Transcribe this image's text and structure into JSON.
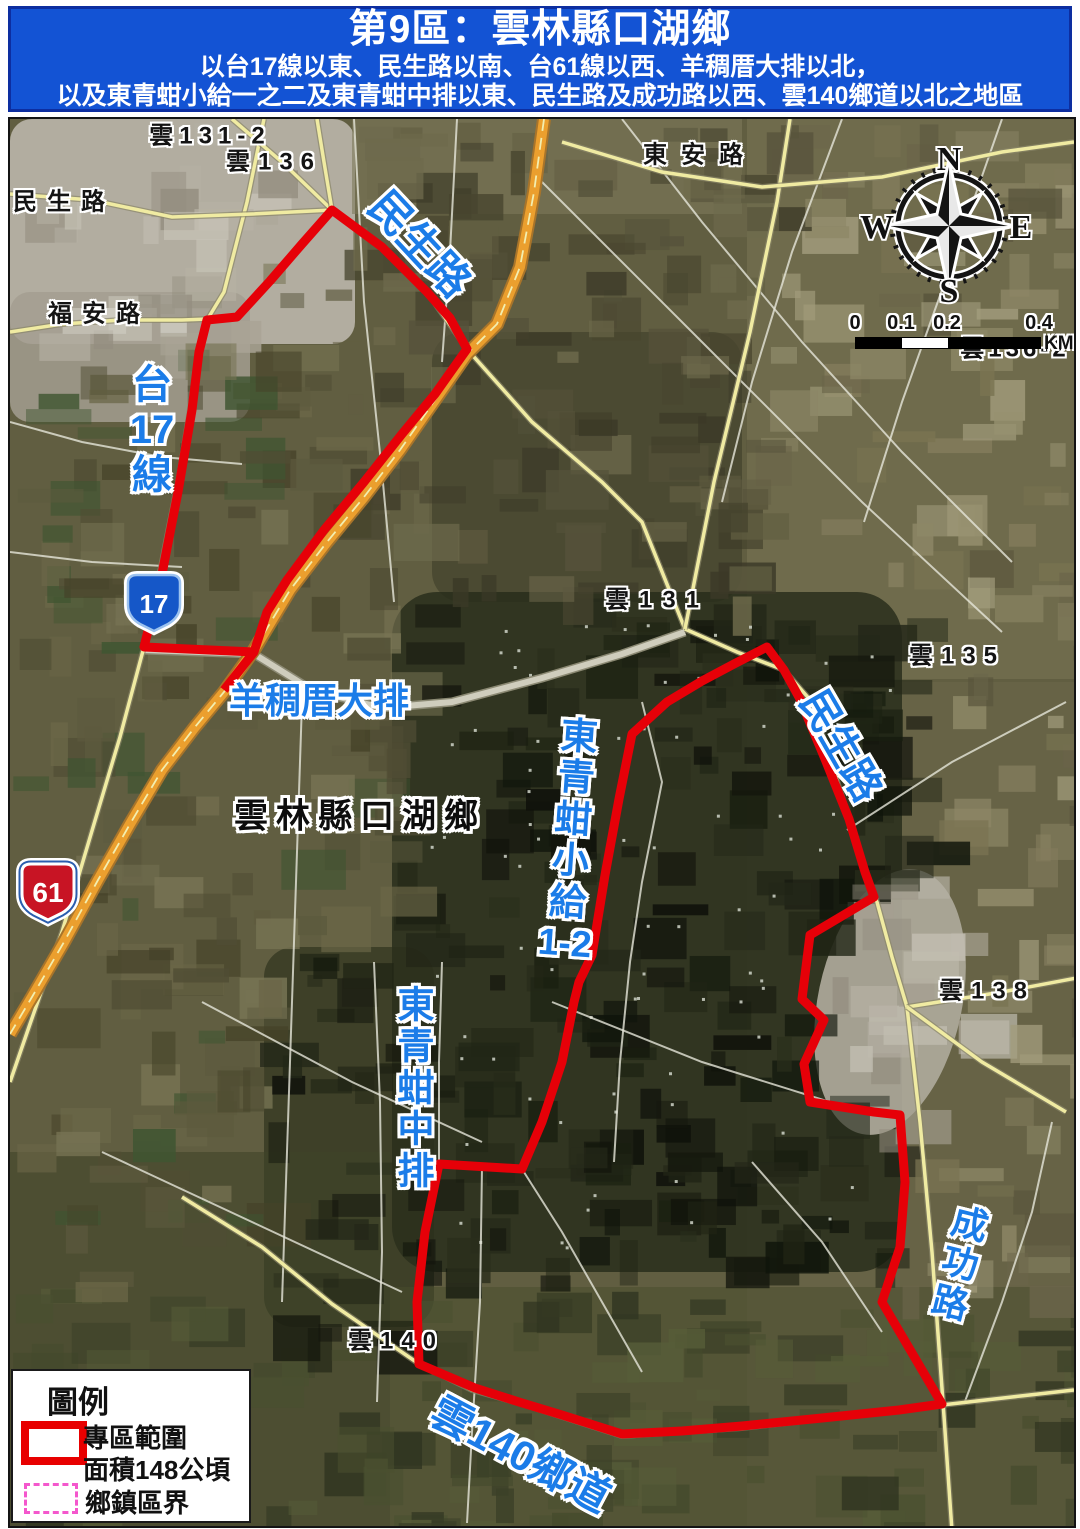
{
  "header": {
    "title": "第9區：雲林縣口湖鄉",
    "subtitle1": "以台17線以東、民生路以南、台61線以西、羊稠厝大排以北，",
    "subtitle2": "以及東青蚶小給一之二及東青蚶中排以東、民生路及成功路以西、雲140鄉道以北之地區"
  },
  "map": {
    "boundary_color": "#e60008",
    "road_label_color": "#1b7ce8",
    "labels": [
      {
        "id": "yun-131-2",
        "text": "雲131-2",
        "x": 208,
        "y": 131,
        "kind": "place",
        "ls": 6
      },
      {
        "id": "yun-136",
        "text": "雲136",
        "x": 272,
        "y": 157,
        "kind": "place",
        "ls": 8
      },
      {
        "id": "minsheng-road-black",
        "text": "民生路",
        "x": 62,
        "y": 197,
        "kind": "place",
        "ls": 10
      },
      {
        "id": "fuan-road",
        "text": "福安路",
        "x": 97,
        "y": 309,
        "kind": "place",
        "ls": 10
      },
      {
        "id": "dongan-road",
        "text": "東安路",
        "x": 698,
        "y": 150,
        "kind": "place",
        "ls": 14
      },
      {
        "id": "yun-131",
        "text": "雲131",
        "x": 655,
        "y": 595,
        "kind": "place",
        "ls": 10
      },
      {
        "id": "yun-135",
        "text": "雲135",
        "x": 955,
        "y": 651,
        "kind": "place",
        "ls": 8
      },
      {
        "id": "yun-138",
        "text": "雲138",
        "x": 985,
        "y": 986,
        "kind": "place",
        "ls": 8
      },
      {
        "id": "yun-140",
        "text": "雲140",
        "x": 394,
        "y": 1336,
        "kind": "place",
        "ls": 8
      },
      {
        "id": "yun-136-2",
        "text": "雲136-2",
        "x": 1013,
        "y": 344,
        "kind": "place",
        "ls": 4,
        "z": 20
      },
      {
        "id": "township-name",
        "text": "雲林縣口湖鄉",
        "x": 358,
        "y": 811,
        "kind": "place-big",
        "ls": 8
      },
      {
        "id": "minsheng-road-north",
        "text": "民生路",
        "x": 420,
        "y": 240,
        "kind": "road",
        "rot": 47,
        "size": 42
      },
      {
        "id": "tai-17-line",
        "parts": [
          "台",
          "17",
          "線"
        ],
        "x": 150,
        "y": 428,
        "kind": "road-v",
        "size": 40
      },
      {
        "id": "yangchoucuo-drain",
        "text": "羊稠厝大排",
        "x": 317,
        "y": 696,
        "kind": "road",
        "rot": 0,
        "size": 36
      },
      {
        "id": "dongqinghan-xiaogei-1-2",
        "parts": [
          "東",
          "青",
          "蚶",
          "小",
          "給",
          "1-2"
        ],
        "x": 570,
        "y": 838,
        "kind": "road-v",
        "size": 37,
        "rot": 4
      },
      {
        "id": "dongqinghan-zhongpai",
        "parts": [
          "東",
          "青",
          "蚶",
          "中",
          "排"
        ],
        "x": 414,
        "y": 1086,
        "kind": "road-v",
        "size": 37
      },
      {
        "id": "minsheng-road-east",
        "text": "民生路",
        "x": 842,
        "y": 742,
        "kind": "road",
        "rot": 60,
        "size": 40
      },
      {
        "id": "chenggong-road",
        "parts": [
          "成",
          "功",
          "路"
        ],
        "x": 958,
        "y": 1262,
        "kind": "road-v",
        "size": 36,
        "rot": 14
      },
      {
        "id": "yun-140-township-road",
        "text": "雲140鄉道",
        "x": 520,
        "y": 1450,
        "kind": "road",
        "rot": 28,
        "size": 42
      }
    ],
    "shields": [
      {
        "route": "17",
        "kind": "provincial-highway",
        "x": 152,
        "y": 601
      },
      {
        "route": "61",
        "kind": "expressway",
        "x": 46,
        "y": 890
      }
    ],
    "compass": {
      "n": "N",
      "e": "E",
      "s": "S",
      "w": "W"
    },
    "scalebar": {
      "ticks": [
        "0",
        "0.1",
        "0.2",
        "0.4"
      ],
      "unit": "KM"
    }
  },
  "legend": {
    "title": "圖例",
    "items": [
      {
        "label": "專區範圍",
        "sublabel": "面積148公頃",
        "swatch": "zone-boundary"
      },
      {
        "label": "鄉鎮區界",
        "swatch": "township-boundary"
      }
    ]
  }
}
